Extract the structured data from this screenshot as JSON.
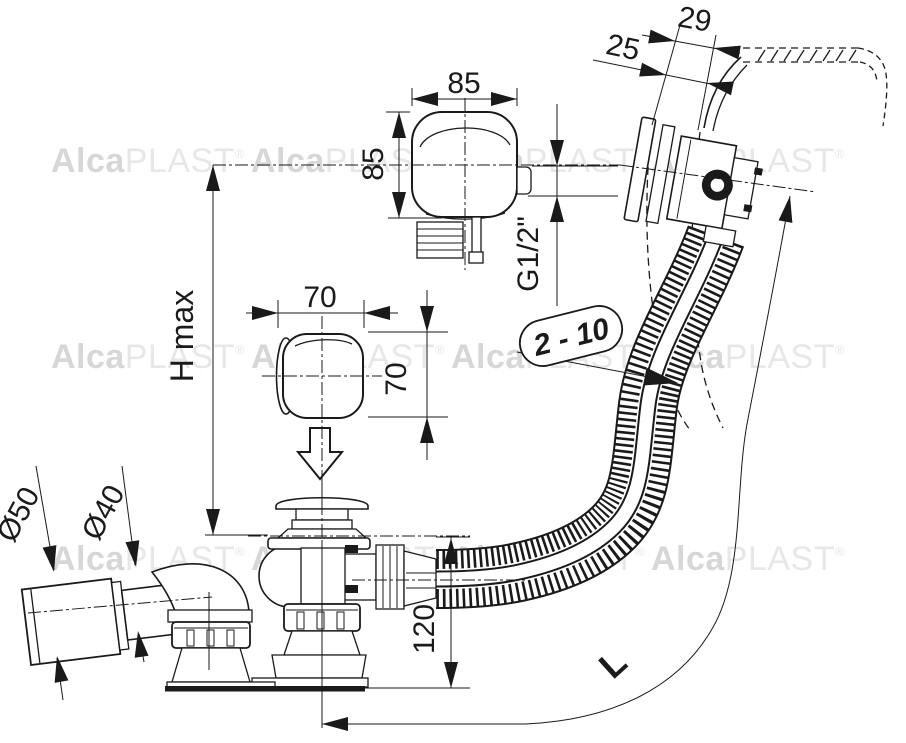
{
  "labels": {
    "knob_top_width": "85",
    "knob_top_height": "85",
    "knob_mid_width": "70",
    "knob_mid_height": "70",
    "overflow_depth": "29",
    "overflow_offset": "25",
    "thread_size": "G1/2\"",
    "wall_thickness_range": "2 - 10",
    "height_max": "H max",
    "outlet_outer_dia": "Ø50",
    "outlet_inner_dia": "Ø40",
    "drain_height": "120",
    "hose_length": "L"
  },
  "watermark": {
    "alca": "Alca",
    "plast": "PLAST",
    "reg": "®"
  },
  "colors": {
    "line": "#1a1a1a",
    "background": "#ffffff",
    "wm-a": "#d7d7d7",
    "wm-b": "#e7e7e7"
  }
}
